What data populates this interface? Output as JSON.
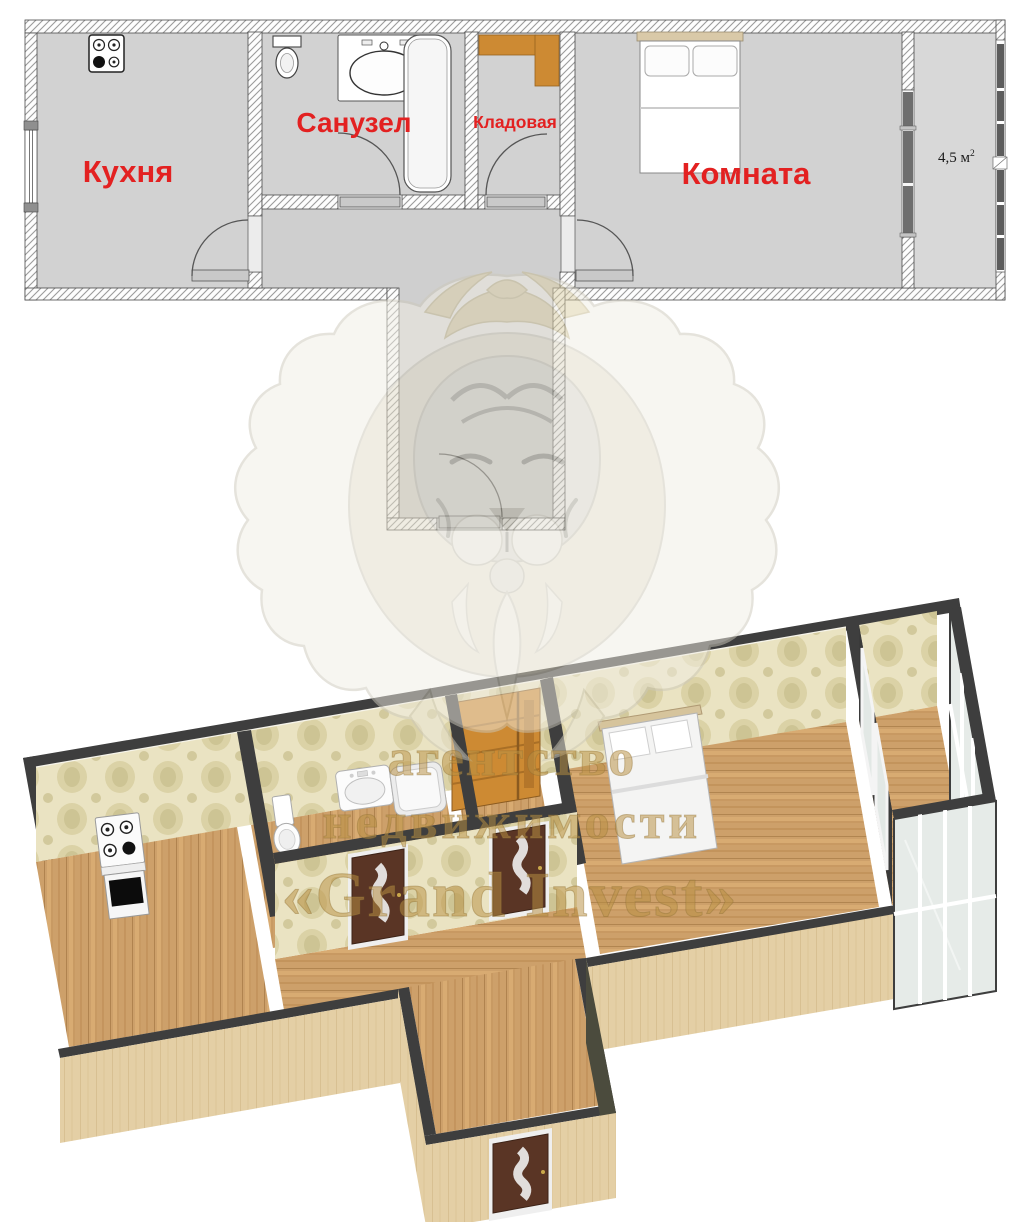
{
  "document_type": "apartment floor plan flyer",
  "plan2d": {
    "kitchen_label": "Кухня",
    "bathroom_label": "Санузел",
    "storage_label": "Кладовая",
    "room_label": "Комната",
    "balcony_area": "4,5 м",
    "balcony_area_sup": "2",
    "label_color": "#e32121"
  },
  "watermark": {
    "line1": "агентство",
    "line2": "недвижимости",
    "line3": "«Grand Invest»",
    "text_color": "#b99044",
    "logo": "lion-head"
  },
  "palette": {
    "wall_dark": "#3e3e3e",
    "plan_floor_gray": "#d2d2d2",
    "wood_floor": "#cfa066",
    "wallpaper": "#eae3c2",
    "door_brown": "#5a3525",
    "shelf_orange": "#cd8a33"
  }
}
